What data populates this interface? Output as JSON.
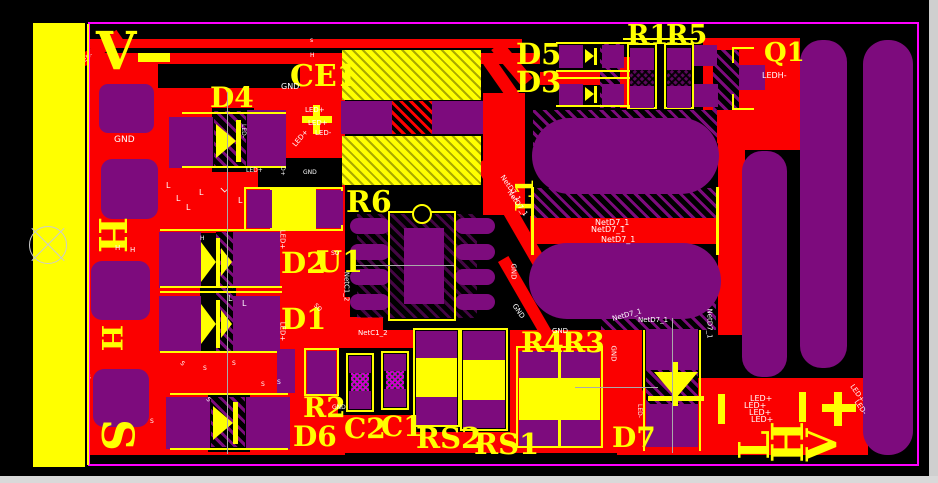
{
  "colors": {
    "background": "#000000",
    "copper": "#FB0000",
    "pad_purple": "#7D0B7D",
    "silkscreen": "#FFFF00",
    "board_outline": "#FF00FF",
    "net_text": "#FFFFFF",
    "screen_edge": "#D9D9D9"
  },
  "designators": {
    "ce1": "CE1",
    "d4": "D4",
    "d5": "D5",
    "d3": "D3",
    "r1": "R1",
    "r5": "R5",
    "q1": "Q1",
    "r6": "R6",
    "u1": "U1",
    "d2": "D2",
    "d1": "D1",
    "l1": "L1",
    "r2": "R2",
    "d6": "D6",
    "c2": "C2",
    "c1": "C1",
    "rs2": "RS2",
    "rs1": "RS1",
    "r4": "R4",
    "r3": "R3",
    "d7": "D7"
  },
  "pin_labels": {
    "v": "V",
    "h": "H",
    "s": "S",
    "l": "L",
    "plus": "+"
  },
  "net_labels": {
    "gnd": "GND",
    "netd7_1": "NetD7_1",
    "netc1_2": "NetC1_2",
    "led_plus": "LED+",
    "led_minus": "LED-",
    "ledh_minus": "LEDH-",
    "d_plus": "D+",
    "so": "SO",
    "s_small": "s",
    "h_small": "H",
    "l_small": "L"
  }
}
